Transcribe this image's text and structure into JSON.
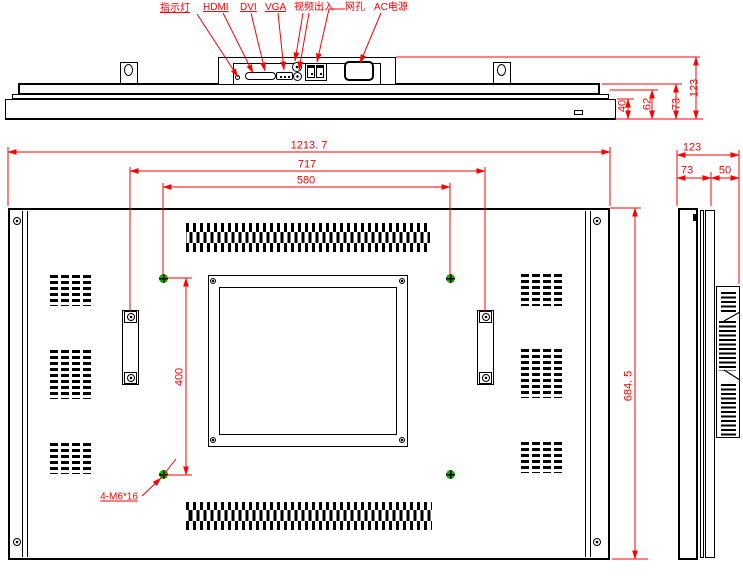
{
  "connector_labels": {
    "indicator": "指示灯",
    "hdmi": "HDMI",
    "dvi": "DVI",
    "vga": "VGA",
    "video_io": "视频出入",
    "lan_port": "网孔",
    "ac_power": "AC电源"
  },
  "rear_dims": {
    "overall_width": "1213. 7",
    "handle_span": "717",
    "vesa_width": "580",
    "vesa_height": "400",
    "overall_height": "684. 5",
    "mount_screw_note": "4-M6*16"
  },
  "top_dims": {
    "front": "40",
    "mid": "62",
    "back": "73",
    "total": "123"
  },
  "side_dims": {
    "total": "123",
    "back": "73",
    "front": "50"
  },
  "colors": {
    "dimension_red": "#ff0000",
    "vesa_green": "#00b300",
    "line_black": "#000000"
  }
}
